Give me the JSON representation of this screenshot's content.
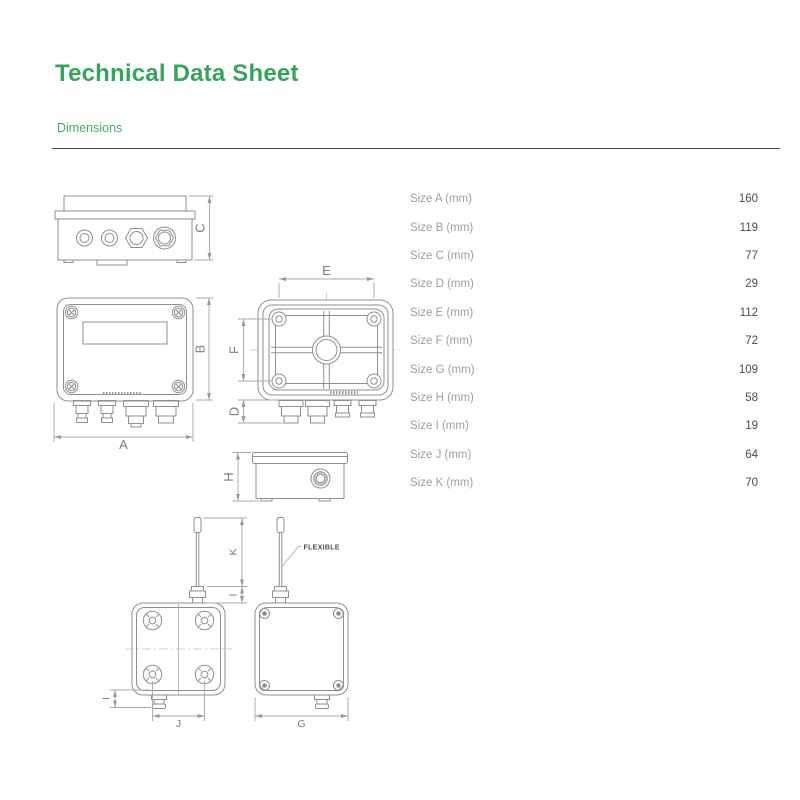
{
  "header": {
    "title": "Technical Data Sheet",
    "section_label": "Dimensions"
  },
  "dimensions_table": {
    "rows": [
      {
        "label": "Size A (mm)",
        "value": "160"
      },
      {
        "label": "Size B (mm)",
        "value": "119"
      },
      {
        "label": "Size C (mm)",
        "value": "77"
      },
      {
        "label": "Size D (mm)",
        "value": "29"
      },
      {
        "label": "Size E (mm)",
        "value": "112"
      },
      {
        "label": "Size F (mm)",
        "value": "72"
      },
      {
        "label": "Size G (mm)",
        "value": "109"
      },
      {
        "label": "Size H (mm)",
        "value": "58"
      },
      {
        "label": "Size I (mm)",
        "value": "19"
      },
      {
        "label": "Size J (mm)",
        "value": "64"
      },
      {
        "label": "Size K (mm)",
        "value": "70"
      }
    ]
  },
  "drawings": {
    "dimension_labels": {
      "a": "A",
      "b": "B",
      "c": "C",
      "d": "D",
      "e": "E",
      "f": "F",
      "g": "G",
      "h": "H",
      "i": "I",
      "i_left": "I",
      "j": "J",
      "k": "K"
    },
    "annotations": {
      "flexible": "FLEXIBLE"
    }
  },
  "colors": {
    "accent_green": "#36a45c",
    "section_green": "#4aa969",
    "drawing_line": "#8f8f8f",
    "dimension_line": "#a8a8a8",
    "table_label": "#9f9f9f",
    "table_value": "#4b4b4b",
    "rule": "#454545"
  }
}
